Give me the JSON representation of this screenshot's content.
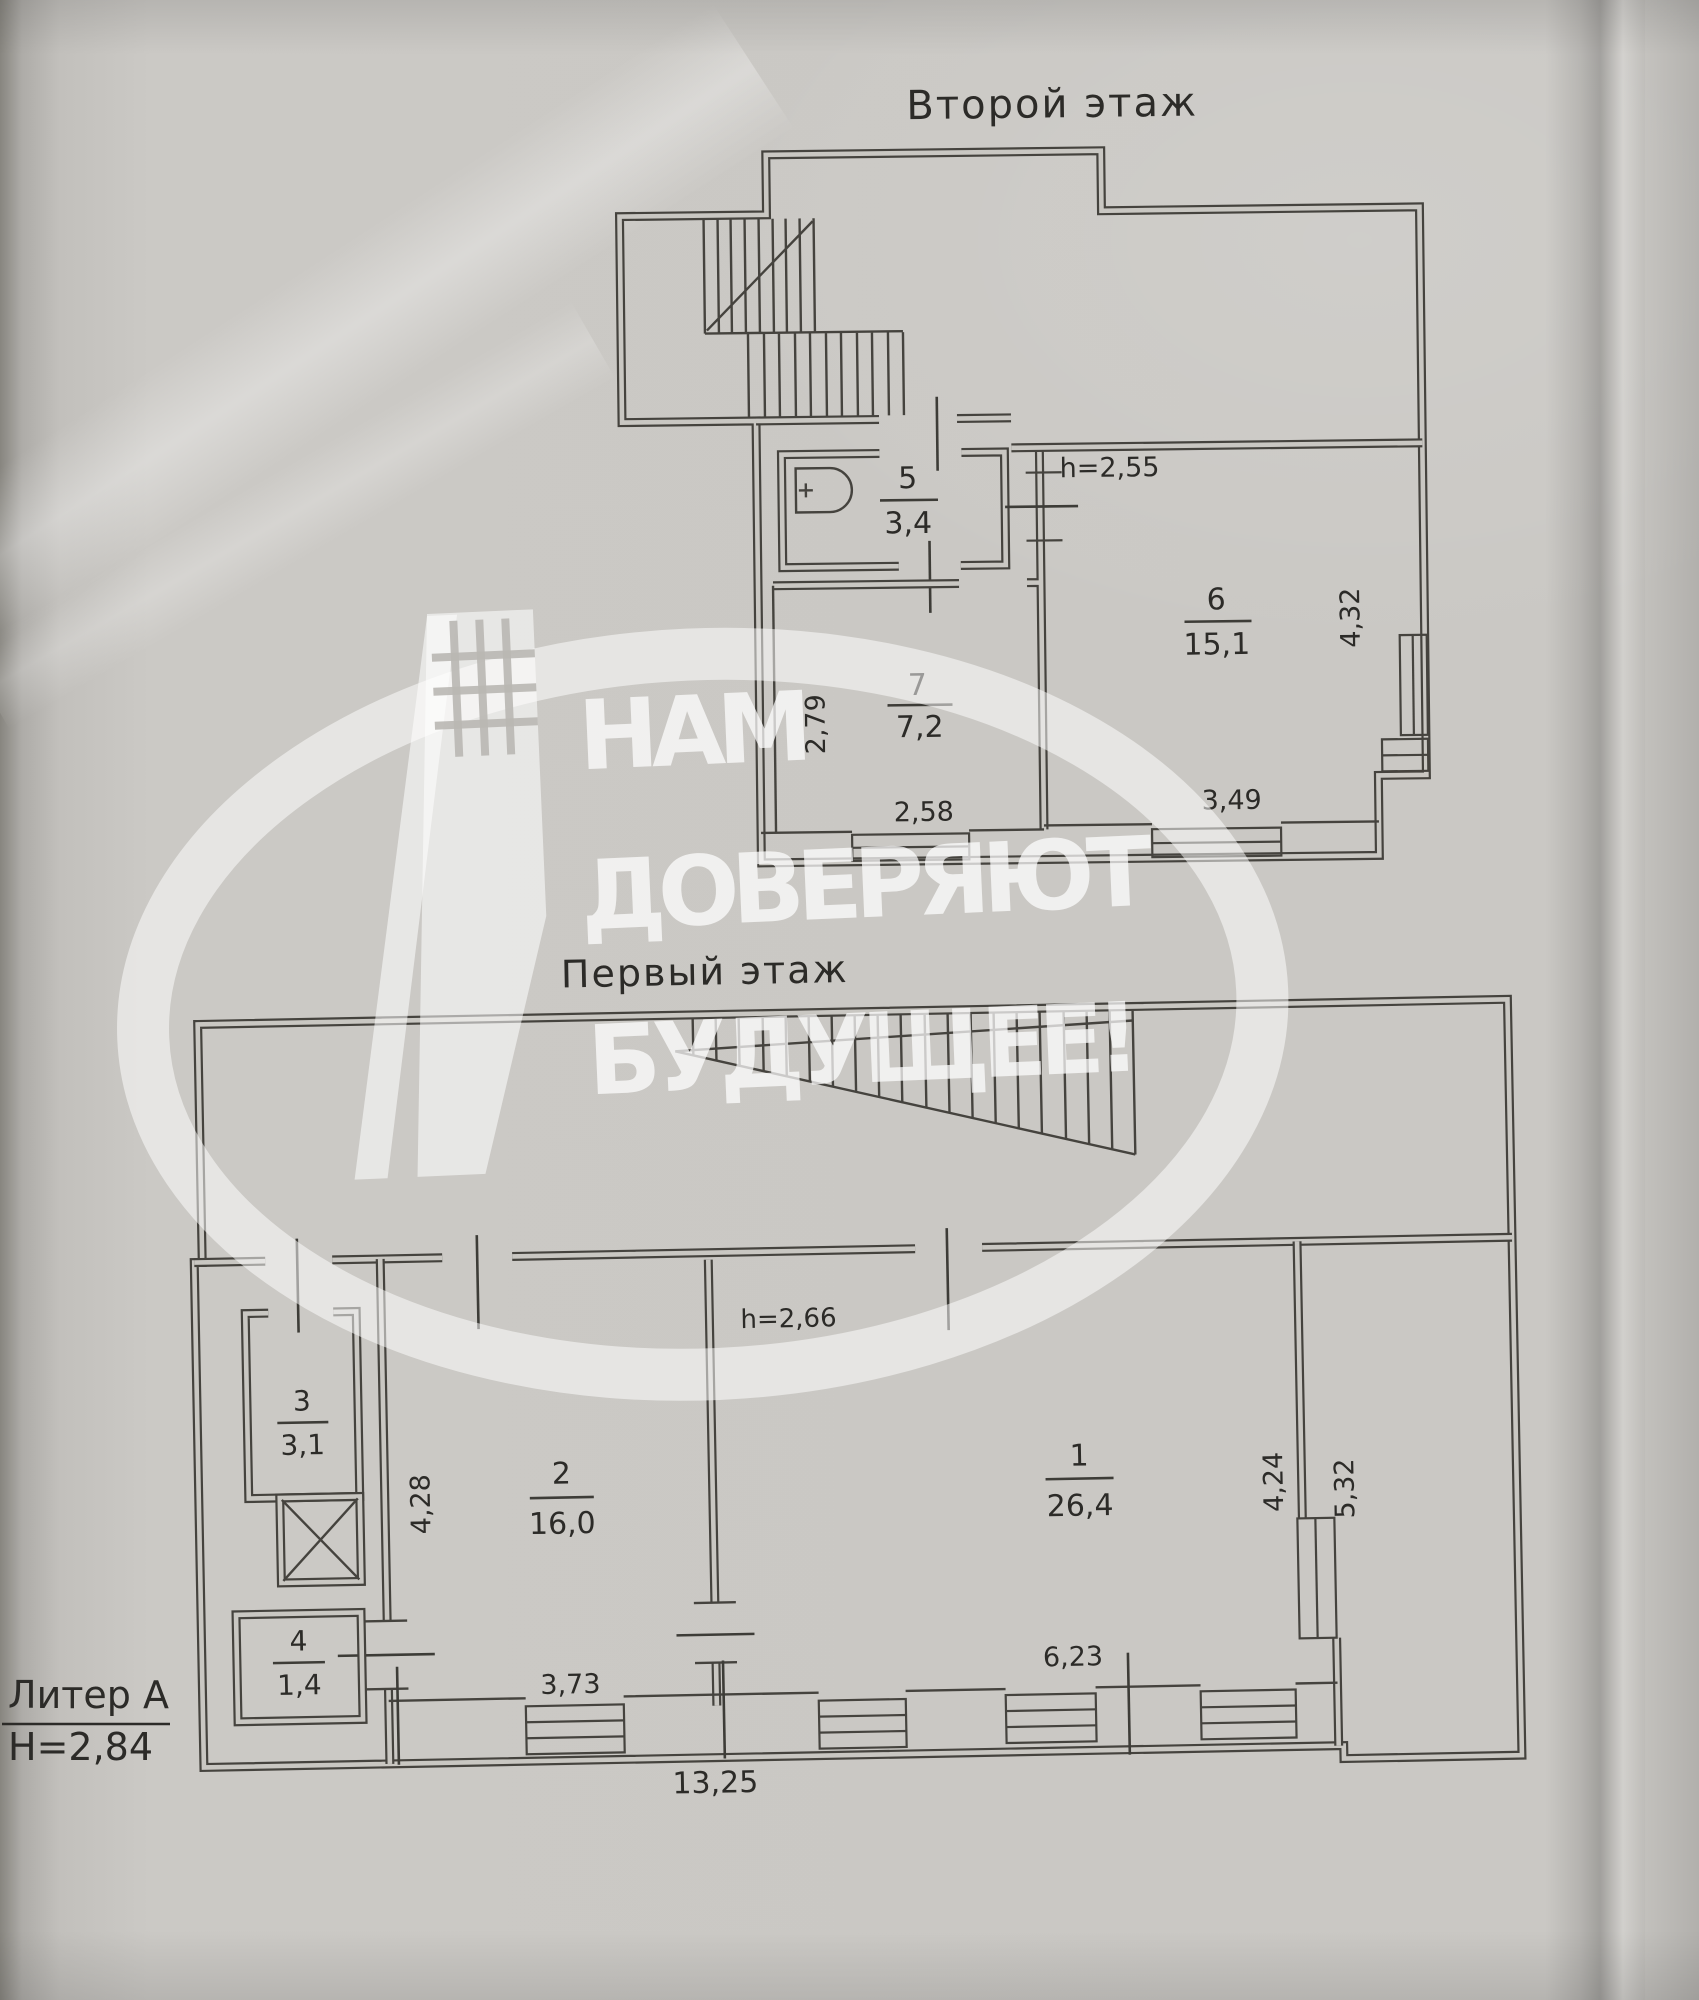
{
  "document": {
    "floor2": {
      "title": "Второй этаж",
      "ceiling_height": "h=2,55",
      "rooms": [
        {
          "number": "5",
          "area": "3,4"
        },
        {
          "number": "7",
          "area": "7,2"
        },
        {
          "number": "6",
          "area": "15,1"
        }
      ],
      "dims": {
        "room7_depth": "2,79",
        "room7_width": "2,58",
        "room6_width": "3,49",
        "room6_depth": "4,32"
      }
    },
    "floor1": {
      "title": "Первый этаж",
      "ceiling_height": "h=2,66",
      "rooms": [
        {
          "number": "1",
          "area": "26,4"
        },
        {
          "number": "2",
          "area": "16,0"
        },
        {
          "number": "3",
          "area": "3,1"
        },
        {
          "number": "4",
          "area": "1,4"
        }
      ],
      "dims": {
        "room2_depth": "4,28",
        "room2_width": "3,73",
        "room1_width": "6,23",
        "room1_depth": "4,24",
        "side": "5,32",
        "total_width": "13,25"
      }
    },
    "legend": {
      "building": "Литер А",
      "floor_height": "Н=2,84"
    },
    "watermark": {
      "line1": "НАМ",
      "line2": "ДОВЕРЯЮТ",
      "line3": "БУДУЩЕЕ!"
    }
  }
}
